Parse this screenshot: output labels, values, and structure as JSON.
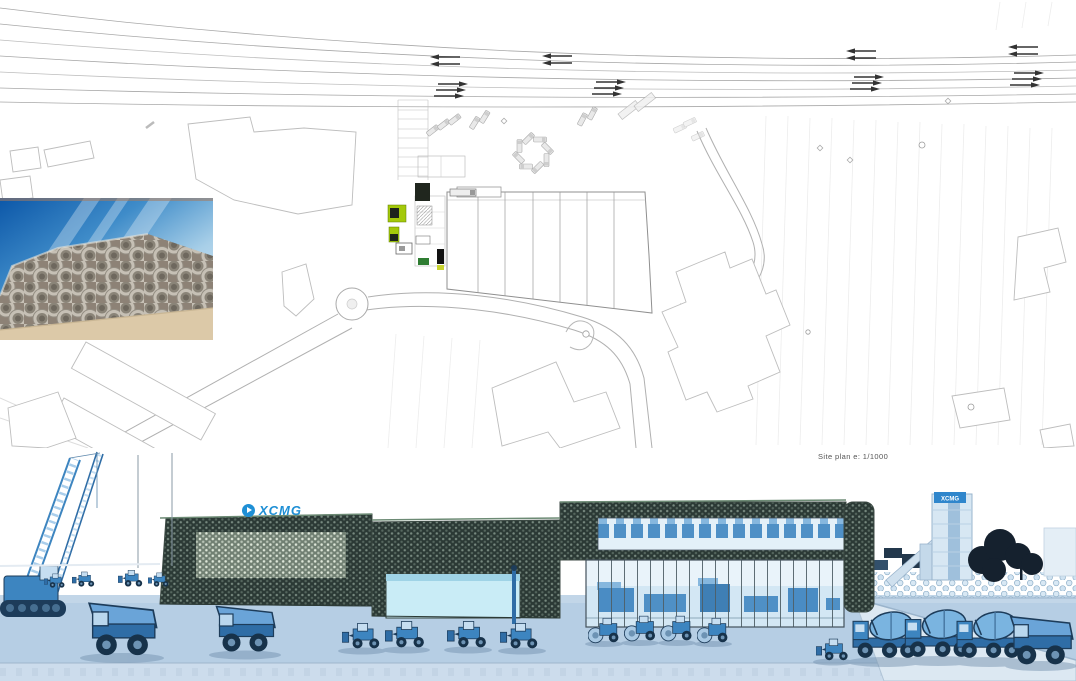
{
  "site_plan": {
    "caption": "Site plan e: 1/1000"
  },
  "render": {
    "building_logo": "XCMG",
    "tower_sign": "XCMG"
  },
  "photo": {
    "subject": "stacked-concrete-pipes-photo"
  },
  "colors": {
    "logo_blue": "#1e8fd5",
    "facade_mesh_dark": "#2b3935",
    "showroom_glass": "#d3e7f4",
    "ground_blue": "#b6cee4",
    "machinery_blue": "#3d85c0",
    "plan_line_gray": "#b5b5b5",
    "photo_sky_blue": "#0c57a8"
  }
}
